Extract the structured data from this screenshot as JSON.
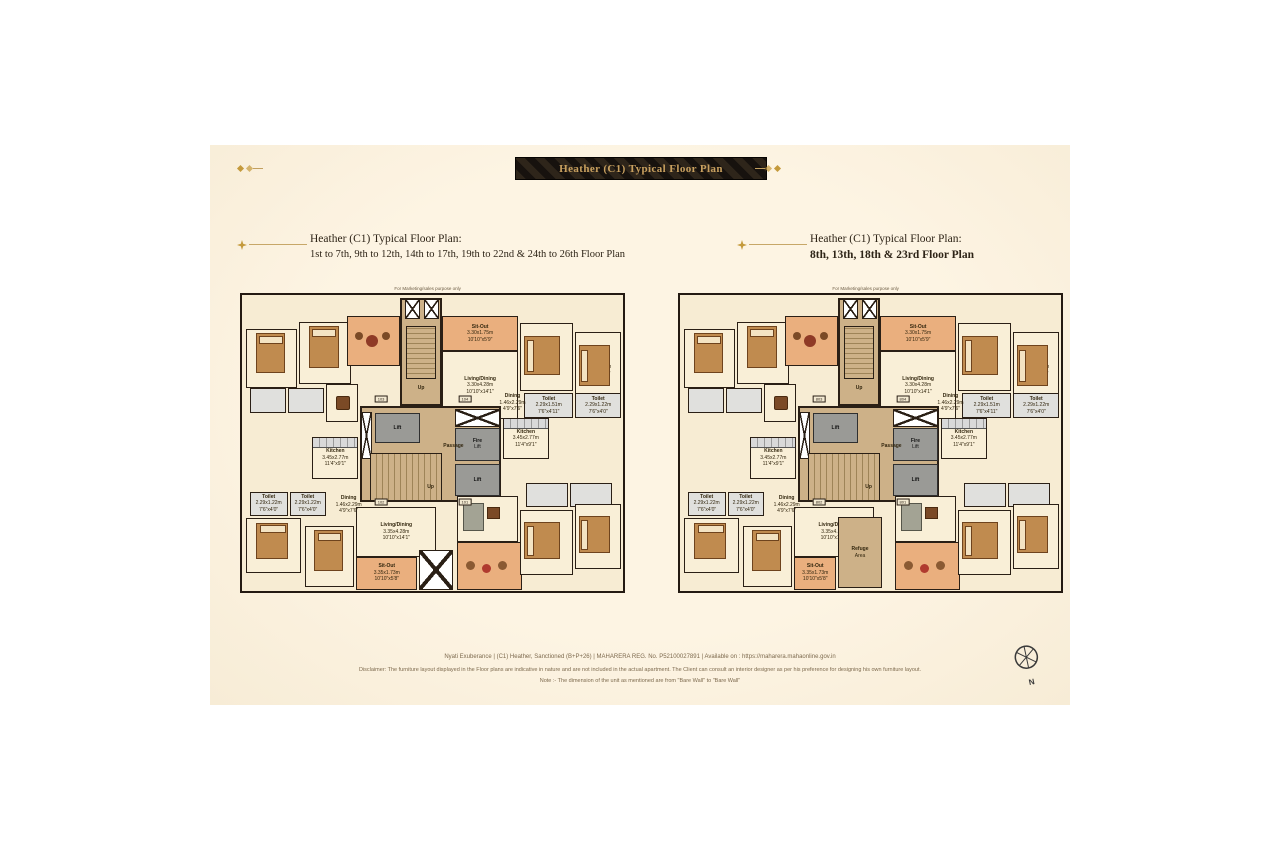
{
  "banner": {
    "title": "Heather (C1) Typical Floor Plan"
  },
  "plans": [
    {
      "title1": "Heather (C1) Typical Floor Plan:",
      "title2": "1st to 7th, 9th to 12th, 14th to 17th, 19th to 22nd & 24th to 26th Floor Plan",
      "note": "For Marketing/sales purpose only",
      "door_tags": [
        "103",
        "104",
        "102",
        "101"
      ],
      "extra_rooms": [
        {
          "t": "sitout",
          "n": "sit-out",
          "label": [
            "Sit-Out",
            "3.35x1.73m",
            "10'10\"x5'8\""
          ],
          "x": 30,
          "y": 88.5,
          "w": 16,
          "h": 11
        },
        {
          "t": "duct3",
          "n": "service-void",
          "x": 46.5,
          "y": 86,
          "w": 9,
          "h": 13.5
        }
      ]
    },
    {
      "title1": "Heather (C1) Typical Floor Plan:",
      "title2": "8th, 13th, 18th & 23rd Floor Plan",
      "note": "For Marketing/sales purpose only",
      "door_tags": [
        "803",
        "804",
        "802",
        "801"
      ],
      "extra_rooms": [
        {
          "t": "sitout",
          "n": "sit-out",
          "label": [
            "Sit-Out",
            "3.35x1.73m",
            "10'10\"x5'8\""
          ],
          "x": 30,
          "y": 88.5,
          "w": 11,
          "h": 11
        },
        {
          "t": "refuge",
          "n": "refuge-area",
          "label": [
            "Refuge",
            "Area"
          ],
          "x": 41.5,
          "y": 75,
          "w": 11.5,
          "h": 24
        }
      ]
    }
  ],
  "rooms": [
    {
      "t": "room",
      "n": "bedroom",
      "f": "bed-v",
      "x": 1,
      "y": 11.5,
      "w": 13.5,
      "h": 20
    },
    {
      "t": "room",
      "n": "bedroom",
      "f": "bed-v",
      "x": 15,
      "y": 9,
      "w": 13.5,
      "h": 21
    },
    {
      "t": "toilet",
      "n": "toilet",
      "x": 2,
      "y": 31.5,
      "w": 9.5,
      "h": 8.5
    },
    {
      "t": "toilet",
      "n": "toilet",
      "x": 12,
      "y": 31.5,
      "w": 9.5,
      "h": 8.5
    },
    {
      "t": "room",
      "n": "dining-area",
      "f": "table",
      "x": 22,
      "y": 30,
      "w": 8.5,
      "h": 13
    },
    {
      "t": "room",
      "n": "kitchen",
      "label": [
        "Kitchen",
        "3.45x2.77m",
        "11'4\"x9'1\""
      ],
      "f": "counter",
      "x": 18.5,
      "y": 48,
      "w": 12,
      "h": 14
    },
    {
      "t": "sitout",
      "n": "terrace",
      "f": "lounge",
      "x": 27.5,
      "y": 7,
      "w": 14,
      "h": 17
    },
    {
      "t": "core",
      "n": "core-upper",
      "x": 41.5,
      "y": 1,
      "w": 11,
      "h": 36.5
    },
    {
      "t": "duct3",
      "n": "shaft",
      "x": 42.8,
      "y": 1.5,
      "w": 4,
      "h": 6.5
    },
    {
      "t": "duct3",
      "n": "shaft",
      "x": 47.8,
      "y": 1.5,
      "w": 4,
      "h": 6.5
    },
    {
      "t": "stair2",
      "n": "staircase-upper",
      "x": 43,
      "y": 10.5,
      "w": 8,
      "h": 18
    },
    {
      "t": "label",
      "n": "up-label",
      "label": [
        "Up"
      ],
      "x": 44,
      "y": 29.5,
      "w": 6,
      "h": 4
    },
    {
      "t": "sitout",
      "n": "sit-out",
      "label": [
        "Sit-Out",
        "3.30x1.75m",
        "10'10\"x5'9\""
      ],
      "x": 52.5,
      "y": 7,
      "w": 20,
      "h": 12
    },
    {
      "t": "room",
      "n": "living-dining",
      "label": [
        "Living/Dining",
        "3.30x4.28m",
        "10'10\"x14'1\""
      ],
      "x": 52.5,
      "y": 19,
      "w": 20,
      "h": 23
    },
    {
      "t": "room",
      "n": "bedroom",
      "label": [
        "Bed",
        "2.94x3.27m",
        "9'8\"x10'9\""
      ],
      "f": "bed-h",
      "x": 73,
      "y": 9.5,
      "w": 14,
      "h": 23
    },
    {
      "t": "room",
      "n": "bedroom",
      "label": [
        "Bed",
        "3.25x3.54m",
        "10'8\"x11'7\""
      ],
      "f": "bed-h",
      "x": 87.5,
      "y": 12.5,
      "w": 12,
      "h": 24
    },
    {
      "t": "toilet",
      "n": "toilet",
      "label": [
        "Toilet",
        "2.29x1.51m",
        "7'6\"x4'11\""
      ],
      "x": 74,
      "y": 33,
      "w": 13,
      "h": 8.5
    },
    {
      "t": "toilet",
      "n": "toilet",
      "label": [
        "Toilet",
        "2.29x1.22m",
        "7'6\"x4'0\""
      ],
      "x": 87.5,
      "y": 33,
      "w": 12,
      "h": 8.5
    },
    {
      "t": "room",
      "n": "kitchen",
      "label": [
        "Kitchen",
        "3.45x2.77m",
        "11'4\"x9'1\""
      ],
      "f": "counter",
      "x": 68.5,
      "y": 41.5,
      "w": 12,
      "h": 14
    },
    {
      "t": "core",
      "n": "core",
      "x": 31,
      "y": 37.5,
      "w": 37,
      "h": 32.5
    },
    {
      "t": "duct",
      "n": "duct",
      "x": 31.3,
      "y": 39.5,
      "w": 2.8,
      "h": 16
    },
    {
      "t": "lift",
      "n": "lift",
      "label": [
        "Lift"
      ],
      "x": 34.8,
      "y": 40,
      "w": 12,
      "h": 10
    },
    {
      "t": "duct2",
      "n": "ac-ledge",
      "x": 55.8,
      "y": 38.5,
      "w": 12,
      "h": 6
    },
    {
      "t": "lift",
      "n": "fire-lift",
      "label": [
        "Fire",
        "Lift"
      ],
      "x": 55.8,
      "y": 45,
      "w": 12,
      "h": 11
    },
    {
      "t": "lift",
      "n": "lift",
      "label": [
        "Lift"
      ],
      "x": 55.8,
      "y": 57,
      "w": 12,
      "h": 11
    },
    {
      "t": "stair",
      "n": "staircase",
      "x": 33.5,
      "y": 53.5,
      "w": 19,
      "h": 16
    },
    {
      "t": "label",
      "n": "passage-label",
      "label": [
        "Passage"
      ],
      "x": 49.5,
      "y": 48.5,
      "w": 12,
      "h": 5
    },
    {
      "t": "label",
      "n": "up-label",
      "label": [
        "Up"
      ],
      "x": 46.5,
      "y": 63,
      "w": 6,
      "h": 4
    },
    {
      "t": "toilet",
      "n": "toilet",
      "label": [
        "Toilet",
        "2.29x1.22m",
        "7'6\"x4'0\""
      ],
      "x": 2,
      "y": 66.5,
      "w": 10,
      "h": 8
    },
    {
      "t": "toilet",
      "n": "toilet",
      "label": [
        "Toilet",
        "2.29x1.22m",
        "7'6\"x4'0\""
      ],
      "x": 12.5,
      "y": 66.5,
      "w": 9.5,
      "h": 8
    },
    {
      "t": "label",
      "n": "dining-label",
      "label": [
        "Dining",
        "1.46x2.29m",
        "4'9\"x7'6\""
      ],
      "x": 23,
      "y": 66.5,
      "w": 10,
      "h": 9
    },
    {
      "t": "room",
      "n": "bedroom",
      "label": [
        "Bed",
        "3.25x3.54m",
        "10'8\"x11'7\""
      ],
      "f": "bed-v",
      "x": 1,
      "y": 75.5,
      "w": 14.5,
      "h": 18.5
    },
    {
      "t": "room",
      "n": "bedroom",
      "label": [
        "Bed",
        "2.94x3.27m",
        "9'8\"x10'9\""
      ],
      "f": "bed-v",
      "x": 16.5,
      "y": 78,
      "w": 13,
      "h": 20.5
    },
    {
      "t": "room",
      "n": "living-dining",
      "label": [
        "Living/Dining",
        "3.35x4.28m",
        "10'10\"x14'1\""
      ],
      "x": 30,
      "y": 71.5,
      "w": 21,
      "h": 17
    },
    {
      "t": "room",
      "n": "living-room",
      "f": "sofa",
      "x": 56.5,
      "y": 68,
      "w": 16,
      "h": 15.5
    },
    {
      "t": "sitout",
      "n": "sit-out",
      "f": "round-tables",
      "x": 56.5,
      "y": 83.5,
      "w": 17,
      "h": 16
    },
    {
      "t": "toilet",
      "n": "toilet",
      "x": 74.5,
      "y": 63.5,
      "w": 11,
      "h": 8
    },
    {
      "t": "toilet",
      "n": "toilet",
      "x": 86,
      "y": 63.5,
      "w": 11,
      "h": 8
    },
    {
      "t": "room",
      "n": "bedroom",
      "f": "bed-h",
      "x": 73,
      "y": 72.5,
      "w": 14,
      "h": 22
    },
    {
      "t": "room",
      "n": "bedroom",
      "f": "bed-h",
      "x": 87.5,
      "y": 70.5,
      "w": 12,
      "h": 22
    },
    {
      "t": "label",
      "n": "dining-label",
      "label": [
        "Dining",
        "1.46x2.29m",
        "4'9\"x7'6\""
      ],
      "x": 66.5,
      "y": 32,
      "w": 9,
      "h": 9
    }
  ],
  "tag_positions": [
    [
      36.5,
      35
    ],
    [
      58.5,
      35
    ],
    [
      36.5,
      70
    ],
    [
      58.5,
      70
    ]
  ],
  "footer": {
    "line1": "Nyati Exuberance | (C1) Heather, Sanctioned (B+P+26) | MAHARERA REG. No. P52100027891 | Available on : https://maharera.mahaonline.gov.in",
    "line2": "Disclaimer: The furniture layout displayed in the Floor plans are indicative in nature and are not included in the actual apartment. The Client can consult an interior designer as per his preference for designing his own furniture layout.",
    "line3": "Note :- The dimension of the unit as mentioned are from \"Bare Wall\" to \"Bare Wall\""
  },
  "compass": {
    "label": "N"
  },
  "colors": {
    "page_background": "#fdf3e1",
    "banner_bg": "#17120e",
    "banner_text": "#c8a05f",
    "gold_accent": "#c49a3c",
    "wall": "#2a1f15",
    "room_fill": "#f9efd7",
    "sitout_fill": "#eaaf7e",
    "core_fill": "#cdb188",
    "lift_fill": "#9a9a96",
    "toilet_fill": "#e0e0dd"
  }
}
